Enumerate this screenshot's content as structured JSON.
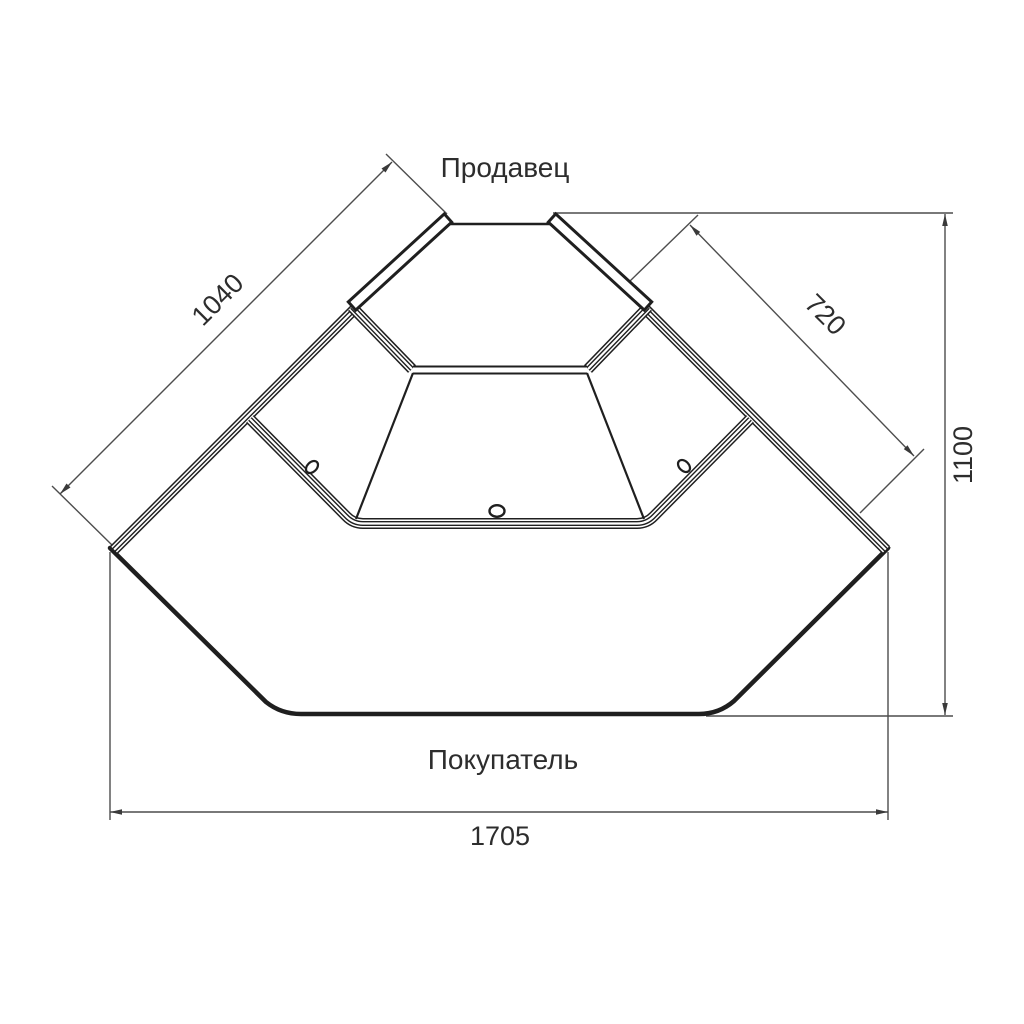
{
  "drawing": {
    "title": "corner-display-counter-top-view",
    "top_label": "Продавец",
    "bottom_label": "Покупатель",
    "dimensions": {
      "left_side": "1040",
      "right_side": "720",
      "overall_depth": "1100",
      "overall_width": "1705"
    },
    "colors": {
      "background": "#ffffff",
      "line": "#1f1f1f",
      "dimension_line": "#4d4d4d",
      "text": "#2d2d2d"
    }
  }
}
